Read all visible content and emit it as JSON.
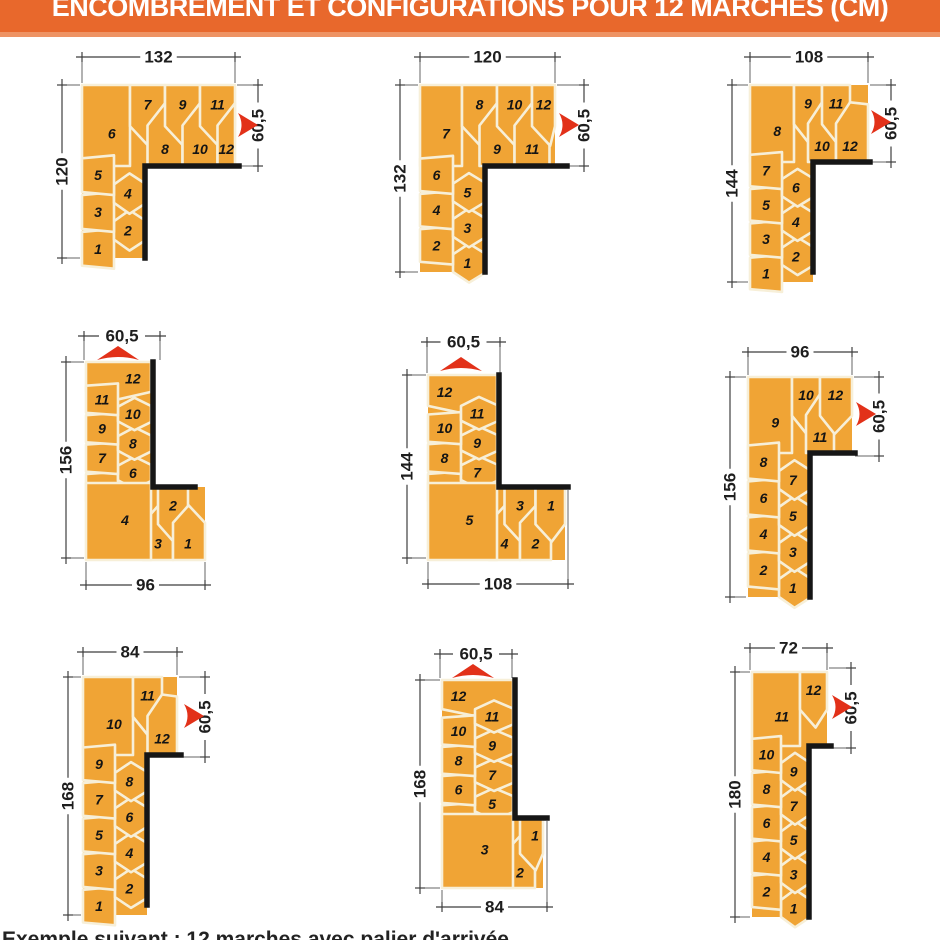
{
  "title": "ENCOMBREMENT ET CONFIGURATIONS POUR 12 MARCHES (CM)",
  "caption_truncated": "Exemple suivant : 12 marches avec palier d'arrivée",
  "total_steps": 12,
  "colors": {
    "banner": "#E8682C",
    "banner_edge": "#EE9364",
    "step_orange": "#F0A435",
    "separator_cream": "#F7EFD8",
    "wall_black": "#161616",
    "arrow_red": "#E23119",
    "dim_line": "#3F3F3F",
    "dim_text": "#1E1E1E",
    "number": "#141414"
  },
  "diagrams": [
    {
      "name": "config-132x120",
      "type": "A",
      "steps_before_corner": 5,
      "corner_step": 6,
      "geom": {
        "vx": 82,
        "w1": 32,
        "w2": 31,
        "topY": 85,
        "wallY": 166,
        "botY": 258,
        "cornerW": 48,
        "pw": 35,
        "hxEnd": 235,
        "wallEndX": 239
      },
      "dims": [
        {
          "side": "top",
          "label": "132",
          "pos": 57,
          "a": 82,
          "b": 235
        },
        {
          "side": "left",
          "label": "120",
          "pos": 62,
          "a": 85,
          "b": 258
        },
        {
          "side": "right",
          "label": "60,5",
          "pos": 258,
          "a": 85,
          "b": 166
        }
      ],
      "arrow": {
        "dir": "right",
        "x": 238,
        "y": 125
      }
    },
    {
      "name": "config-120x132",
      "type": "A",
      "steps_before_corner": 6,
      "corner_step": 7,
      "geom": {
        "vx": 420,
        "w1": 33,
        "w2": 32,
        "topY": 85,
        "wallY": 166,
        "botY": 272,
        "cornerW": 42,
        "pw": 35,
        "hxEnd": 555,
        "wallEndX": 567
      },
      "dims": [
        {
          "side": "top",
          "label": "120",
          "pos": 57,
          "a": 420,
          "b": 555
        },
        {
          "side": "left",
          "label": "132",
          "pos": 400,
          "a": 85,
          "b": 272
        },
        {
          "side": "right",
          "label": "60,5",
          "pos": 584,
          "a": 85,
          "b": 166
        }
      ],
      "arrow": {
        "dir": "right",
        "x": 559,
        "y": 125
      }
    },
    {
      "name": "config-108x144",
      "type": "A",
      "steps_before_corner": 7,
      "corner_step": 8,
      "geom": {
        "vx": 750,
        "w1": 32,
        "w2": 31,
        "topY": 85,
        "wallY": 162,
        "botY": 282,
        "cornerW": 44,
        "pw": 28,
        "hxEnd": 868,
        "wallEndX": 870,
        "wallBotY": 272
      },
      "dims": [
        {
          "side": "top",
          "label": "108",
          "pos": 57,
          "a": 750,
          "b": 868
        },
        {
          "side": "left",
          "label": "144",
          "pos": 732,
          "a": 85,
          "b": 282
        },
        {
          "side": "right",
          "label": "60,5",
          "pos": 891,
          "a": 85,
          "b": 162
        }
      ],
      "arrow": {
        "dir": "right",
        "x": 871,
        "y": 122
      }
    },
    {
      "name": "config-96x156-exit-top",
      "type": "B",
      "entrance_steps": 3,
      "corner_step": 4,
      "geom": {
        "vx": 86,
        "w1": 32,
        "w2": 33,
        "topY": 362,
        "wallY": 487,
        "botY": 560,
        "pw": 30,
        "hxEnd": 205,
        "wallEndX": 195
      },
      "dims": [
        {
          "side": "top",
          "label": "60,5",
          "pos": 336,
          "a": 84,
          "b": 160
        },
        {
          "side": "left",
          "label": "156",
          "pos": 66,
          "a": 362,
          "b": 558
        },
        {
          "side": "bottom",
          "label": "96",
          "pos": 585,
          "a": 86,
          "b": 205
        }
      ],
      "arrow": {
        "dir": "up",
        "x": 118,
        "y": 351
      }
    },
    {
      "name": "config-108x144-exit-top",
      "type": "B",
      "entrance_steps": 4,
      "corner_step": 5,
      "geom": {
        "vx": 428,
        "w1": 33,
        "w2": 36,
        "topY": 375,
        "wallY": 487,
        "botY": 560,
        "pw": 31,
        "hxEnd": 565,
        "wallEndX": 568
      },
      "dims": [
        {
          "side": "top",
          "label": "60,5",
          "pos": 342,
          "a": 427,
          "b": 500
        },
        {
          "side": "left",
          "label": "144",
          "pos": 407,
          "a": 375,
          "b": 558
        },
        {
          "side": "bottom",
          "label": "108",
          "pos": 584,
          "a": 428,
          "b": 568
        }
      ],
      "arrow": {
        "dir": "up",
        "x": 461,
        "y": 362
      }
    },
    {
      "name": "config-96x156",
      "type": "A",
      "steps_before_corner": 8,
      "corner_step": 9,
      "geom": {
        "vx": 748,
        "w1": 31,
        "w2": 31,
        "topY": 377,
        "wallY": 453,
        "botY": 597,
        "cornerW": 44,
        "pw": 28,
        "hxEnd": 852,
        "wallEndX": 855
      },
      "dims": [
        {
          "side": "top",
          "label": "96",
          "pos": 352,
          "a": 748,
          "b": 852
        },
        {
          "side": "left",
          "label": "156",
          "pos": 730,
          "a": 377,
          "b": 597
        },
        {
          "side": "right",
          "label": "60,5",
          "pos": 879,
          "a": 377,
          "b": 456
        }
      ],
      "arrow": {
        "dir": "right",
        "x": 856,
        "y": 414
      }
    },
    {
      "name": "config-84x168",
      "type": "A",
      "steps_before_corner": 9,
      "corner_step": 10,
      "geom": {
        "vx": 83,
        "w1": 32,
        "w2": 32,
        "topY": 677,
        "wallY": 755,
        "botY": 915,
        "cornerW": 50,
        "pw": 29,
        "hxEnd": 177,
        "wallEndX": 181,
        "wallBotY": 905
      },
      "dims": [
        {
          "side": "top",
          "label": "84",
          "pos": 652,
          "a": 83,
          "b": 177
        },
        {
          "side": "left",
          "label": "168",
          "pos": 68,
          "a": 677,
          "b": 915
        },
        {
          "side": "right",
          "label": "60,5",
          "pos": 205,
          "a": 677,
          "b": 757
        }
      ],
      "arrow": {
        "dir": "right",
        "x": 184,
        "y": 716
      }
    },
    {
      "name": "config-84x168-exit-top",
      "type": "B",
      "entrance_steps": 2,
      "corner_step": 3,
      "geom": {
        "vx": 442,
        "w1": 33,
        "w2": 38,
        "topY": 680,
        "wallY": 818,
        "botY": 888,
        "pw": 30,
        "hxEnd": 543,
        "wallEndX": 547
      },
      "dims": [
        {
          "side": "top",
          "label": "60,5",
          "pos": 654,
          "a": 440,
          "b": 512
        },
        {
          "side": "left",
          "label": "168",
          "pos": 420,
          "a": 680,
          "b": 888
        },
        {
          "side": "bottom",
          "label": "84",
          "pos": 907,
          "a": 442,
          "b": 547
        }
      ],
      "arrow": {
        "dir": "up",
        "x": 473,
        "y": 669
      }
    },
    {
      "name": "config-72x180",
      "type": "A",
      "steps_before_corner": 10,
      "corner_step": 11,
      "geom": {
        "vx": 752,
        "w1": 29,
        "w2": 28,
        "topY": 672,
        "wallY": 746,
        "botY": 917,
        "cornerW": 48,
        "pw": 30,
        "hxEnd": 827,
        "wallEndX": 831
      },
      "dims": [
        {
          "side": "top",
          "label": "72",
          "pos": 648,
          "a": 750,
          "b": 827
        },
        {
          "side": "left",
          "label": "180",
          "pos": 735,
          "a": 672,
          "b": 917
        },
        {
          "side": "right",
          "label": "60,5",
          "pos": 851,
          "a": 668,
          "b": 748
        }
      ],
      "arrow": {
        "dir": "right",
        "x": 832,
        "y": 707
      }
    }
  ]
}
